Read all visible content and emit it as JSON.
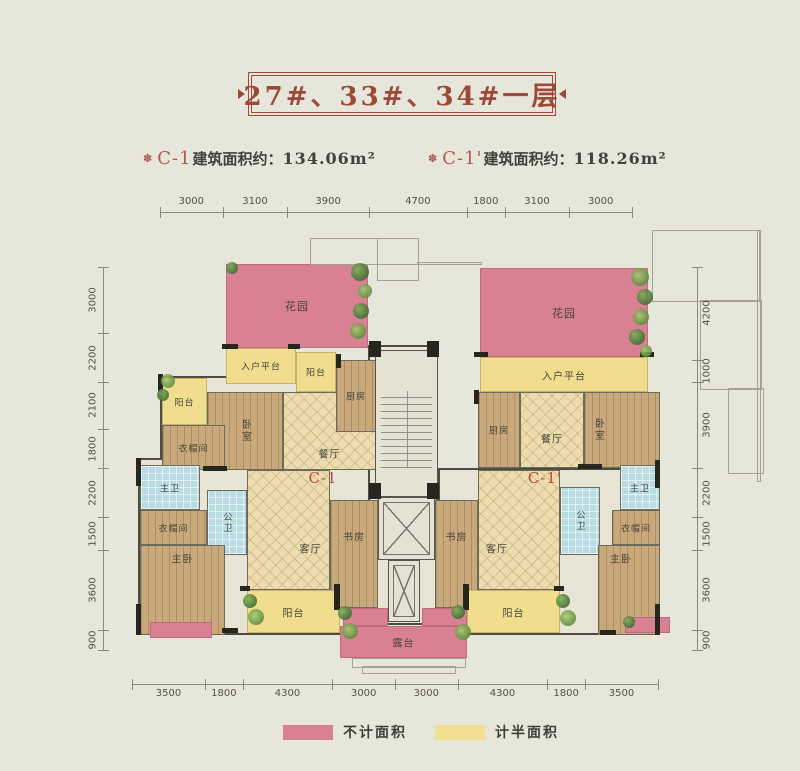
{
  "title": {
    "text": "27#、33#、34#一层"
  },
  "subtitles": {
    "left": {
      "icon": "✽",
      "code": "C-1",
      "text": "建筑面积约：",
      "value": "134.06m²"
    },
    "right": {
      "icon": "✽",
      "code": "C-1'",
      "text": "建筑面积约：",
      "value": "118.26m²"
    }
  },
  "colors": {
    "background": "#e7e6da",
    "title_accent": "#9c4937",
    "unit_code_red": "#b04b3e",
    "pink_not_counted": "#d98093",
    "yellow_half_counted": "#f2df8f",
    "tile_floor": "#ecdcae",
    "wood_floor": "#c9a87c",
    "bath_floor": "#b9dce2"
  },
  "dimensions": {
    "top": {
      "x": 160,
      "y": 212,
      "len": 472,
      "values": [
        "3000",
        "3100",
        "3900",
        "4700",
        "1800",
        "3100",
        "3000"
      ]
    },
    "bottom": {
      "x": 132,
      "y": 684,
      "len": 526,
      "values": [
        "3500",
        "1800",
        "4300",
        "3000",
        "3000",
        "4300",
        "1800",
        "3500"
      ]
    },
    "left": {
      "x": 103,
      "y": 267,
      "len": 383,
      "values": [
        "3000",
        "2200",
        "2100",
        "1800",
        "2200",
        "1500",
        "3600",
        "900"
      ]
    },
    "right": {
      "x": 697,
      "y": 267,
      "len": 383,
      "values": [
        "4200",
        "1000",
        "3900",
        "2200",
        "1500",
        "3600",
        "900"
      ]
    }
  },
  "plan": {
    "rooms": [
      {
        "name": "base-left-upper",
        "x": 160,
        "y": 376,
        "w": 218,
        "h": 94,
        "fill": "plain"
      },
      {
        "name": "base-left-lower",
        "x": 138,
        "y": 458,
        "w": 240,
        "h": 177,
        "fill": "plain"
      },
      {
        "name": "base-right-upper",
        "x": 478,
        "y": 392,
        "w": 182,
        "h": 76,
        "fill": "plain"
      },
      {
        "name": "base-right-lower",
        "x": 438,
        "y": 468,
        "w": 222,
        "h": 167,
        "fill": "plain"
      },
      {
        "name": "base-center",
        "x": 368,
        "y": 345,
        "w": 70,
        "h": 280,
        "fill": "plain"
      },
      {
        "name": "garden-left",
        "label": "花园",
        "x": 226,
        "y": 264,
        "w": 142,
        "h": 84,
        "fill": "pink",
        "fs": 11
      },
      {
        "name": "garden-right",
        "label": "花园",
        "x": 480,
        "y": 268,
        "w": 168,
        "h": 89,
        "fill": "pink",
        "fs": 11
      },
      {
        "name": "entry-platform-left",
        "label": "入户平台",
        "x": 226,
        "y": 348,
        "w": 70,
        "h": 36,
        "fill": "yellow",
        "fs": 9
      },
      {
        "name": "entry-platform-right",
        "label": "入户平台",
        "x": 480,
        "y": 357,
        "w": 168,
        "h": 35,
        "fill": "yellow"
      },
      {
        "name": "balcony-left-top",
        "label": "阳台",
        "x": 296,
        "y": 352,
        "w": 40,
        "h": 40,
        "fill": "yellow",
        "fs": 9
      },
      {
        "name": "balcony-left-edge",
        "label": "阳台",
        "x": 162,
        "y": 378,
        "w": 45,
        "h": 47,
        "fill": "yellow",
        "fs": 9
      },
      {
        "name": "dining-left",
        "label": "餐厅",
        "x": 283,
        "y": 392,
        "w": 93,
        "h": 78,
        "fill": "tile",
        "dy": 22
      },
      {
        "name": "kitchen-left",
        "label": "厨房",
        "x": 336,
        "y": 360,
        "w": 40,
        "h": 72,
        "fill": "wood",
        "fs": 9
      },
      {
        "name": "bedroom-left",
        "label": "卧室",
        "x": 207,
        "y": 392,
        "w": 76,
        "h": 78,
        "fill": "wood",
        "v": true
      },
      {
        "name": "cloakroom-left-top",
        "label": "衣帽间",
        "x": 162,
        "y": 425,
        "w": 63,
        "h": 45,
        "fill": "wood",
        "fs": 9
      },
      {
        "name": "bath-master-left",
        "label": "主卫",
        "x": 140,
        "y": 465,
        "w": 60,
        "h": 45,
        "fill": "bath",
        "fs": 9
      },
      {
        "name": "bath-public-left",
        "label": "公卫",
        "x": 207,
        "y": 490,
        "w": 40,
        "h": 65,
        "fill": "bath",
        "v": true,
        "fs": 9
      },
      {
        "name": "cloakroom-left-bottom",
        "label": "衣帽间",
        "x": 140,
        "y": 510,
        "w": 67,
        "h": 35,
        "fill": "wood",
        "fs": 9
      },
      {
        "name": "master-bedroom-left",
        "label": "主卧",
        "x": 140,
        "y": 545,
        "w": 85,
        "h": 90,
        "fill": "wood",
        "dy": -32
      },
      {
        "name": "living-left",
        "label": "客厅",
        "x": 247,
        "y": 470,
        "w": 83,
        "h": 120,
        "fill": "tile",
        "dx": 22,
        "dy": 18
      },
      {
        "name": "study-left",
        "label": "书房",
        "x": 330,
        "y": 500,
        "w": 48,
        "h": 108,
        "fill": "wood",
        "dy": -18
      },
      {
        "name": "balcony-left-bottom",
        "label": "阳台",
        "x": 247,
        "y": 590,
        "w": 93,
        "h": 43,
        "fill": "yellow"
      },
      {
        "name": "flowerbed-left",
        "x": 150,
        "y": 622,
        "w": 62,
        "h": 16,
        "fill": "pink"
      },
      {
        "name": "stairwell",
        "x": 375,
        "y": 350,
        "w": 63,
        "h": 147,
        "fill": "stairs"
      },
      {
        "name": "elevator",
        "x": 378,
        "y": 497,
        "w": 57,
        "h": 63,
        "fill": "elevator"
      },
      {
        "name": "elevator-shaft",
        "x": 388,
        "y": 560,
        "w": 32,
        "h": 62,
        "fill": "elevator"
      },
      {
        "name": "kitchen-right",
        "label": "厨房",
        "x": 478,
        "y": 392,
        "w": 42,
        "h": 76,
        "fill": "wood",
        "fs": 9
      },
      {
        "name": "dining-right",
        "label": "餐厅",
        "x": 520,
        "y": 392,
        "w": 64,
        "h": 76,
        "fill": "tile",
        "dy": 8
      },
      {
        "name": "bedroom-right",
        "label": "卧室",
        "x": 584,
        "y": 392,
        "w": 76,
        "h": 76,
        "fill": "wood",
        "v": true,
        "dx": -24
      },
      {
        "name": "living-right",
        "label": "客厅",
        "x": 478,
        "y": 470,
        "w": 82,
        "h": 120,
        "fill": "tile",
        "dx": -22,
        "dy": 18
      },
      {
        "name": "bath-public-right",
        "label": "公卫",
        "x": 560,
        "y": 487,
        "w": 40,
        "h": 68,
        "fill": "bath",
        "v": true,
        "fs": 9
      },
      {
        "name": "bath-master-right",
        "label": "主卫",
        "x": 620,
        "y": 465,
        "w": 40,
        "h": 45,
        "fill": "bath",
        "fs": 9
      },
      {
        "name": "cloakroom-right",
        "label": "衣帽间",
        "x": 612,
        "y": 510,
        "w": 48,
        "h": 35,
        "fill": "wood",
        "fs": 9
      },
      {
        "name": "master-bedroom-right",
        "label": "主卧",
        "x": 598,
        "y": 545,
        "w": 62,
        "h": 90,
        "fill": "wood",
        "dx": -8,
        "dy": -32
      },
      {
        "name": "study-right",
        "label": "书房",
        "x": 435,
        "y": 500,
        "w": 43,
        "h": 108,
        "fill": "wood",
        "dy": -18
      },
      {
        "name": "balcony-right-bottom",
        "label": "阳台",
        "x": 467,
        "y": 590,
        "w": 93,
        "h": 43,
        "fill": "yellow"
      },
      {
        "name": "flowerbed-right",
        "x": 625,
        "y": 617,
        "w": 45,
        "h": 16,
        "fill": "pink"
      },
      {
        "name": "flowerbox-center-left",
        "x": 343,
        "y": 608,
        "w": 45,
        "h": 18,
        "fill": "pink"
      },
      {
        "name": "flowerbox-center-right",
        "x": 422,
        "y": 608,
        "w": 45,
        "h": 18,
        "fill": "pink"
      },
      {
        "name": "terrace",
        "label": "露台",
        "x": 340,
        "y": 626,
        "w": 127,
        "h": 32,
        "fill": "pink"
      },
      {
        "name": "unit-code-left",
        "label": "C-1",
        "x": 283,
        "y": 467,
        "w": 80,
        "h": 22,
        "fill": "labelonly",
        "code": true
      },
      {
        "name": "unit-code-right",
        "label": "C-1'",
        "x": 505,
        "y": 467,
        "w": 80,
        "h": 22,
        "fill": "labelonly",
        "code": true
      }
    ],
    "walls": [
      [
        369,
        341,
        12,
        16
      ],
      [
        427,
        341,
        12,
        16
      ],
      [
        369,
        483,
        12,
        16
      ],
      [
        427,
        483,
        12,
        16
      ],
      [
        222,
        344,
        16,
        5
      ],
      [
        288,
        344,
        12,
        5
      ],
      [
        474,
        352,
        14,
        5
      ],
      [
        640,
        352,
        14,
        5
      ],
      [
        158,
        374,
        5,
        24
      ],
      [
        136,
        458,
        5,
        28
      ],
      [
        136,
        604,
        5,
        31
      ],
      [
        655,
        460,
        5,
        28
      ],
      [
        655,
        604,
        5,
        31
      ],
      [
        240,
        586,
        10,
        5
      ],
      [
        334,
        584,
        6,
        26
      ],
      [
        463,
        584,
        6,
        26
      ],
      [
        554,
        586,
        10,
        5
      ],
      [
        203,
        466,
        24,
        5
      ],
      [
        578,
        464,
        24,
        5
      ],
      [
        222,
        628,
        16,
        5
      ],
      [
        600,
        630,
        16,
        5
      ],
      [
        336,
        354,
        5,
        14
      ],
      [
        474,
        390,
        5,
        14
      ]
    ],
    "greenery": [
      [
        360,
        272,
        9
      ],
      [
        365,
        291,
        7
      ],
      [
        361,
        311,
        8
      ],
      [
        358,
        331,
        8
      ],
      [
        232,
        268,
        6
      ],
      [
        168,
        381,
        7
      ],
      [
        163,
        395,
        6
      ],
      [
        640,
        277,
        9
      ],
      [
        645,
        297,
        8
      ],
      [
        641,
        317,
        8
      ],
      [
        637,
        337,
        8
      ],
      [
        646,
        351,
        6
      ],
      [
        250,
        601,
        7
      ],
      [
        256,
        617,
        8
      ],
      [
        345,
        613,
        7
      ],
      [
        350,
        631,
        8
      ],
      [
        458,
        612,
        7
      ],
      [
        463,
        632,
        8
      ],
      [
        563,
        601,
        7
      ],
      [
        568,
        618,
        8
      ],
      [
        629,
        622,
        6
      ]
    ],
    "context": [
      [
        310,
        238,
        107,
        25
      ],
      [
        377,
        238,
        40,
        41
      ],
      [
        417,
        262,
        63,
        1
      ],
      [
        652,
        230,
        106,
        70
      ],
      [
        700,
        300,
        60,
        88
      ],
      [
        728,
        388,
        34,
        84
      ],
      [
        757,
        230,
        2,
        250
      ],
      [
        352,
        658,
        112,
        8
      ],
      [
        362,
        666,
        92,
        6
      ]
    ]
  },
  "legend": {
    "items": [
      {
        "swatch_color": "#d98093",
        "label": "不计面积"
      },
      {
        "swatch_color": "#f2df8f",
        "label": "计半面积"
      }
    ]
  }
}
